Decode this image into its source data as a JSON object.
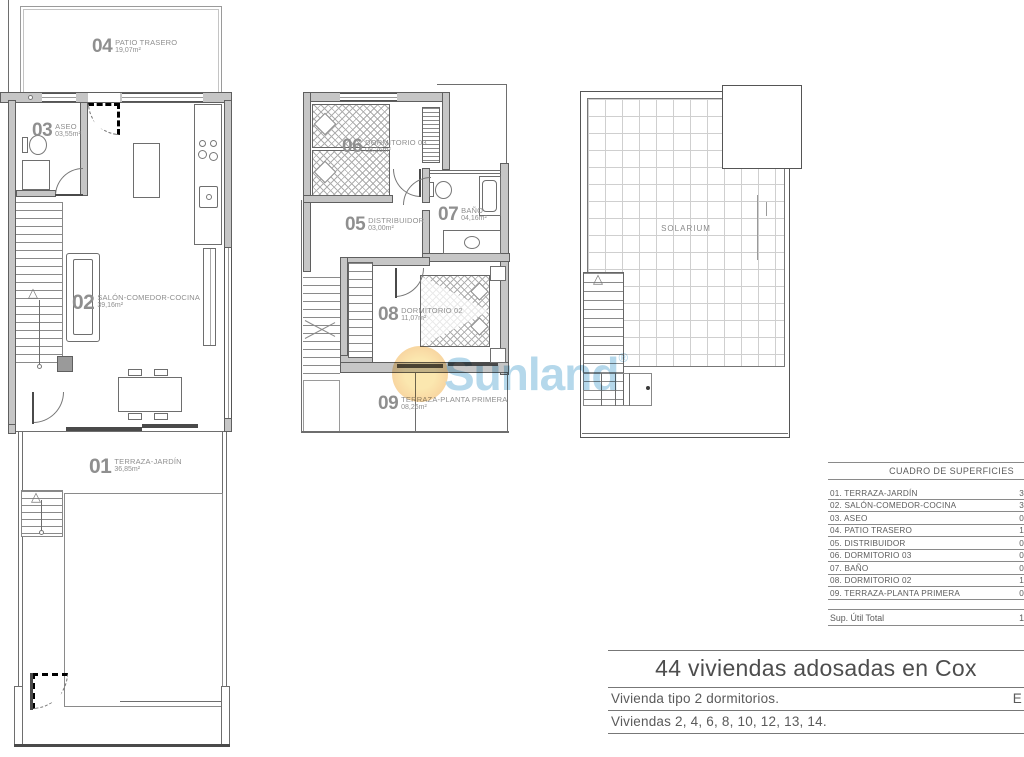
{
  "colors": {
    "wall_fill": "#c6c6c6",
    "line": "#5f5f5f",
    "label_gray": "#8f8f8f",
    "watermark_blue": "#b5d8eb",
    "sun_orange": "#f6cf9d"
  },
  "watermark": {
    "brand": "Sunland",
    "registered": "®"
  },
  "plans": {
    "ground": {
      "rooms": [
        {
          "id": "04",
          "name": "PATIO TRASERO",
          "area": "19,07m²"
        },
        {
          "id": "03",
          "name": "ASEO",
          "area": "03,55m²"
        },
        {
          "id": "02",
          "name": "SALÓN-COMEDOR-COCINA",
          "area": "39,16m²"
        },
        {
          "id": "01",
          "name": "TERRAZA-JARDÍN",
          "area": "36,85m²"
        }
      ]
    },
    "first": {
      "rooms": [
        {
          "id": "06",
          "name": "DORMITORIO 03",
          "area": "08,26m²"
        },
        {
          "id": "05",
          "name": "DISTRIBUIDOR",
          "area": "03,00m²"
        },
        {
          "id": "07",
          "name": "BAÑO",
          "area": "04,16m²"
        },
        {
          "id": "08",
          "name": "DORMITORIO 02",
          "area": "11,07m²"
        },
        {
          "id": "09",
          "name": "TERRAZA-PLANTA PRIMERA",
          "area": "08,26m²"
        }
      ]
    },
    "roof": {
      "label": "SOLARIUM"
    }
  },
  "surface_table": {
    "title": "CUADRO DE SUPERFICIES",
    "rows": [
      {
        "label": "01. TERRAZA-JARDÍN",
        "value": "3"
      },
      {
        "label": "02. SALÓN-COMEDOR-COCINA",
        "value": "3"
      },
      {
        "label": "03. ASEO",
        "value": "0"
      },
      {
        "label": "04. PATIO TRASERO",
        "value": "1"
      },
      {
        "label": "05. DISTRIBUIDOR",
        "value": "0"
      },
      {
        "label": "06. DORMITORIO 03",
        "value": "0"
      },
      {
        "label": "07. BAÑO",
        "value": "0"
      },
      {
        "label": "08. DORMITORIO 02",
        "value": "1"
      },
      {
        "label": "09. TERRAZA-PLANTA PRIMERA",
        "value": "0"
      }
    ],
    "total_label": "Sup. Útil Total",
    "total_value": "1"
  },
  "title_block": {
    "project": "44 viviendas adosadas en Cox",
    "line1": "Vivienda tipo 2 dormitorios.",
    "line1_right": "E",
    "line2": "Viviendas 2, 4, 6, 8, 10, 12, 13, 14."
  }
}
